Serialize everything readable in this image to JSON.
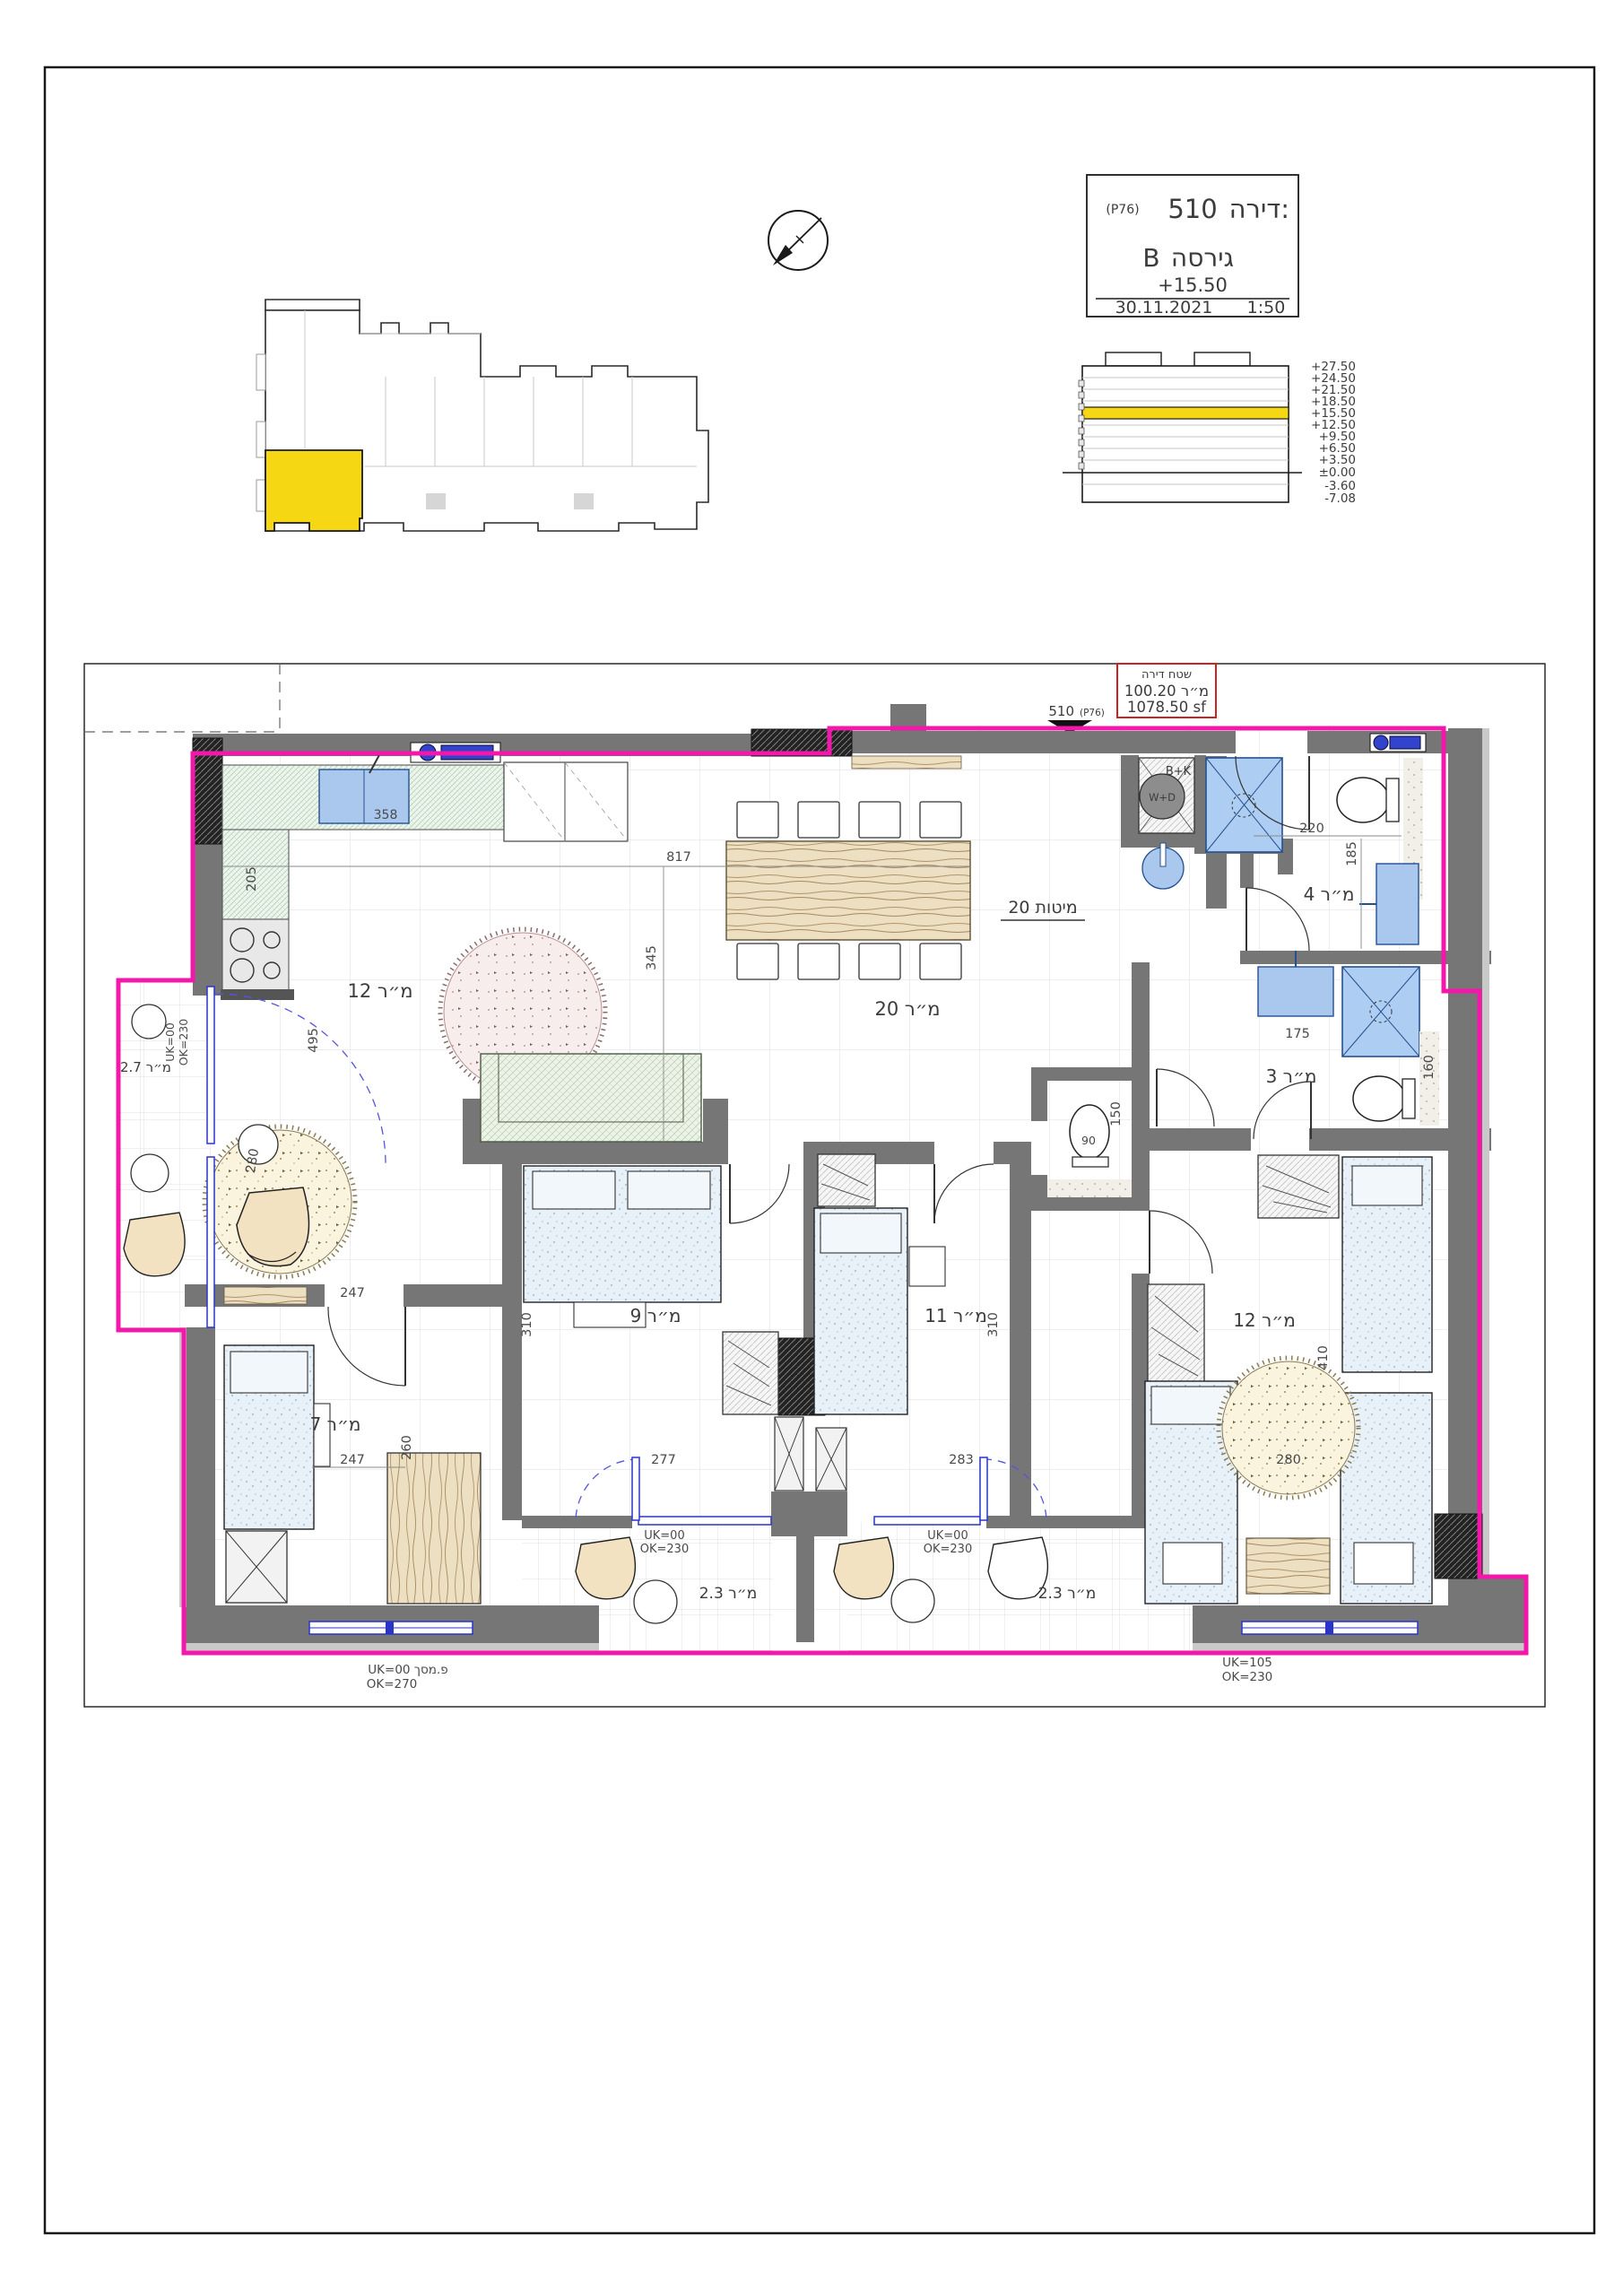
{
  "title_block": {
    "apartment_label": "דירה:",
    "apartment_number": "510",
    "unit_code": "(P76)",
    "version_label": "גירסה",
    "version_value": "B",
    "level": "+15.50",
    "date": "30.11.2021",
    "scale": "1:50"
  },
  "area_box": {
    "title": "שטח דירה",
    "area_sqm": "מ״ר 100.20",
    "area_sqft": "1078.50  sf"
  },
  "entry_marker": {
    "number": "510",
    "code": "(P76)"
  },
  "elevation_key": {
    "levels": [
      "+27.50",
      "+24.50",
      "+21.50",
      "+18.50",
      "+15.50",
      "+12.50",
      "+9.50",
      "+6.50",
      "+3.50",
      "±0.00",
      "-3.60",
      "-7.08"
    ],
    "highlight_level": "+15.50",
    "highlight_color": "#f6d714"
  },
  "plan": {
    "rooms": {
      "kitchen": "מ״ר 12",
      "living": "מ״ר 20",
      "beds_note": "מיטות 20",
      "bath_top": "מ״ר 4",
      "bath_mid": "מ״ר 3",
      "bed_left": "מ״ר 7",
      "bed_mid": "מ״ר 9",
      "bed_right": "מ״ר 11",
      "bed_far": "מ״ר 12",
      "balcony_left": "מ״ר 2.7",
      "balcony_1": "מ״ר 2.3",
      "balcony_2": "מ״ר 2.3"
    },
    "dims": {
      "kitchen_sink": "358",
      "kitchen_w": "205",
      "kitchen_h": "495",
      "living_w": "817",
      "living_h": "345",
      "bath_top_w": "220",
      "bath_top_h": "185",
      "bath_mid_w": "175",
      "bath_mid_h": "160",
      "wc_w": "90",
      "wc_h": "150",
      "bed_left_w1": "247",
      "bed_left_w2": "247",
      "bed_left_h": "260",
      "bed_mid_h": "310",
      "bed_right_h": "310",
      "rug_living": "280",
      "rug_far": "280",
      "bed_far_h": "410",
      "balcony1_w": "277",
      "balcony2_w": "283"
    },
    "notes": {
      "balc_left_uk": "UK=00",
      "balc_left_ok": "OK=230",
      "balc1_uk": "UK=00",
      "balc1_ok": "OK=230",
      "balc2_uk": "UK=00",
      "balc2_ok": "OK=230",
      "win_left_uk": "UK=00 פ.מסך",
      "win_left_ok": "OK=270",
      "win_right_uk": "UK=105",
      "win_right_ok": "OK=230"
    },
    "fixtures": {
      "bk_label": "B+K",
      "wd_label": "W+D"
    },
    "boundary_color": "#f318ab"
  }
}
